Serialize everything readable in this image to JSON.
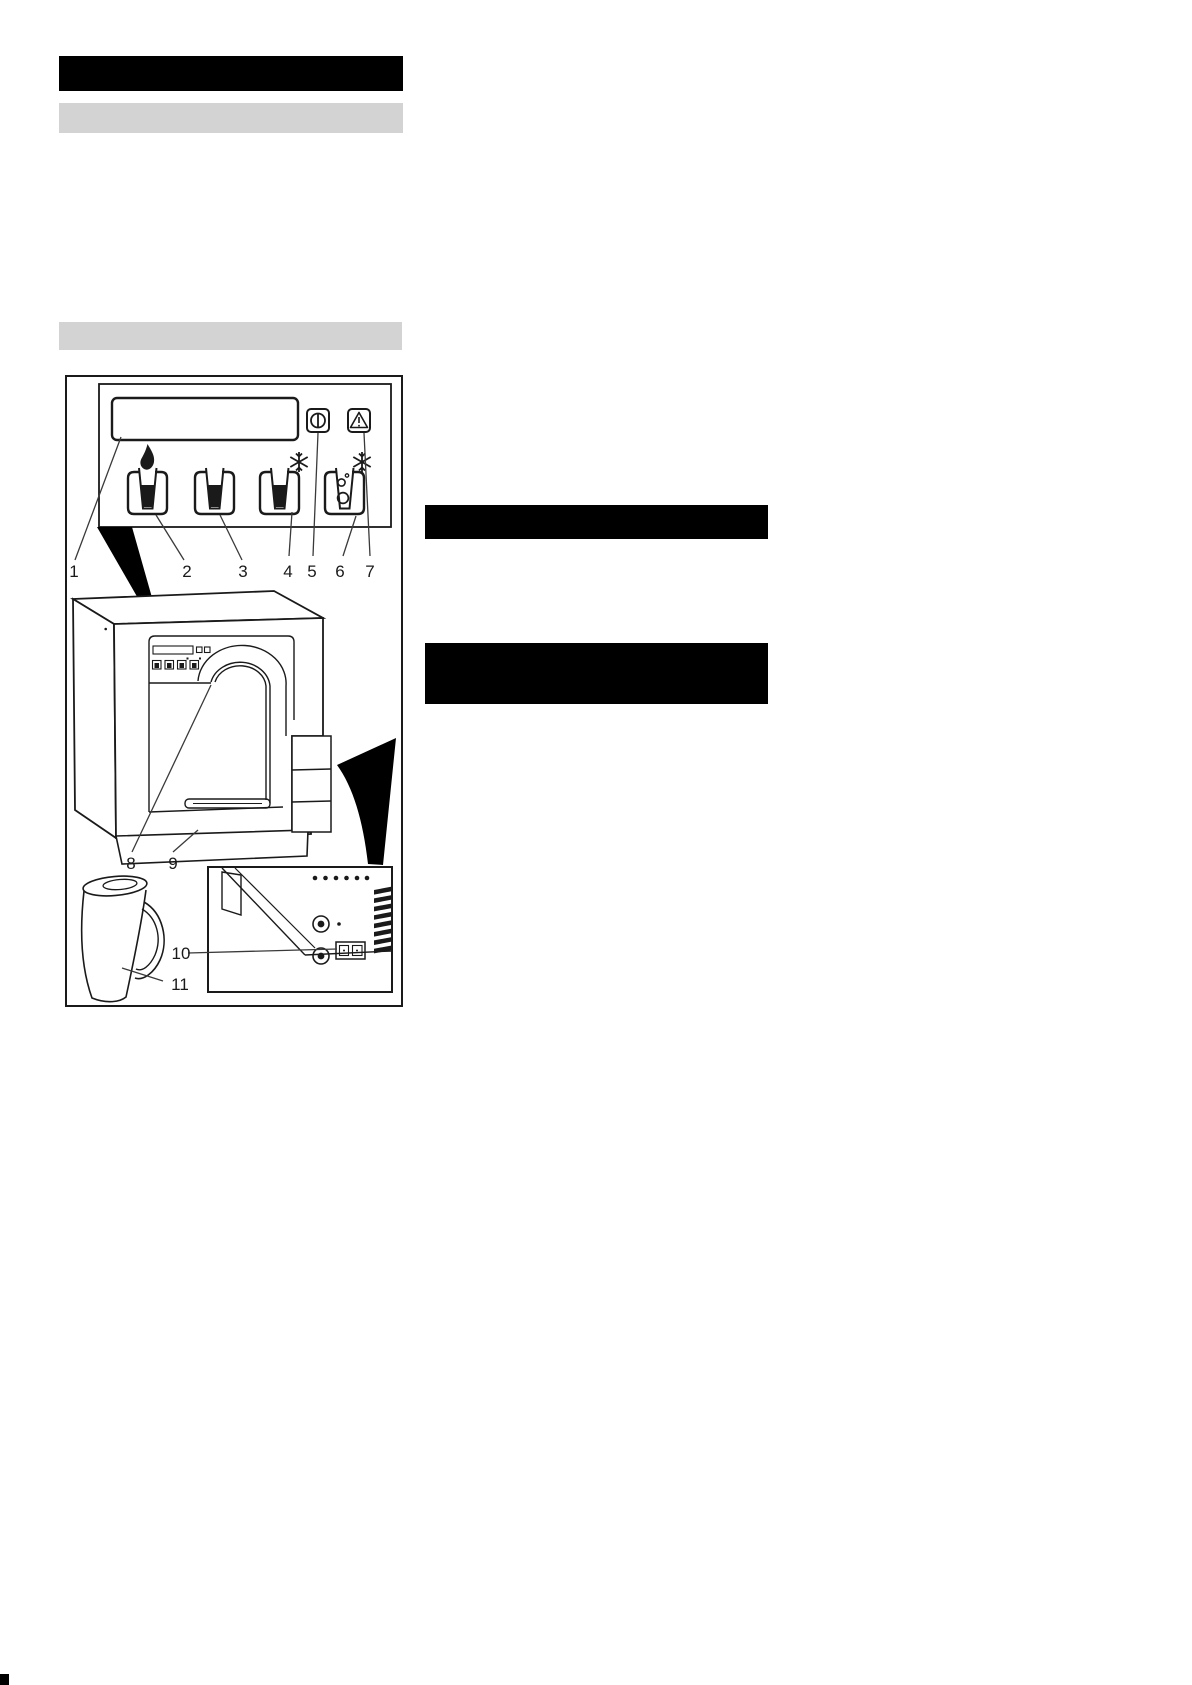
{
  "document": {
    "type": "scanned-manual-page",
    "background_color": "#ffffff",
    "ink_color": "#1a1a1a",
    "redaction_color": "#000000",
    "heading_bar_color": "#d3d3d3"
  },
  "figure": {
    "description": "overview-diagram-water-dispenser",
    "callout_labels": {
      "c1": "1",
      "c2": "2",
      "c3": "3",
      "c4": "4",
      "c5": "5",
      "c6": "6",
      "c7": "7",
      "c8": "8",
      "c9": "9",
      "c10": "10",
      "c11": "11"
    },
    "icons": {
      "display": "lcd-display",
      "power_button": "power-standby-icon",
      "fault_indicator": "warning-triangle-icon",
      "hot_water_button": "cup-with-flame-icon",
      "ambient_water_button": "cup-icon",
      "cold_water_button": "cup-with-snowflake-icon",
      "sparkling_water_button": "cup-with-bubbles-and-snowflake-icon",
      "dispensing_outlet": "arch-dispensing-area",
      "drip_tray": "drip-tray",
      "rear_connections": "power-socket-connectors",
      "jug": "water-jug"
    }
  }
}
